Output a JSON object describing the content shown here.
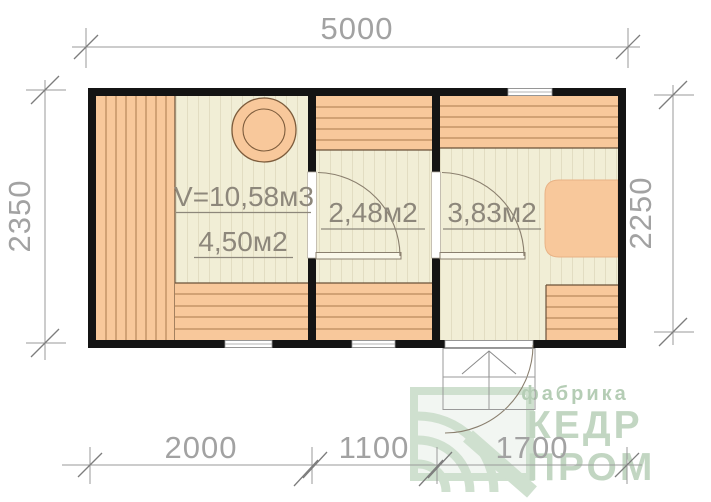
{
  "plan": {
    "dims": {
      "top": "5000",
      "left": "2350",
      "right": "2250",
      "bottom": [
        "2000",
        "1100",
        "1700"
      ]
    },
    "rooms": [
      {
        "id": "steam-room",
        "volume": "V=10,58м3",
        "area": "4,50м2"
      },
      {
        "id": "washing-room",
        "area": "2,48м2"
      },
      {
        "id": "rest-room",
        "area": "3,83м2"
      }
    ],
    "watermark": {
      "factory": "фабрика",
      "brand_top": "КЕДР",
      "brand_bottom": "ПРОМ"
    },
    "colors": {
      "wall": "#141414",
      "wood": "#f8c89b",
      "wood_line": "#aa7a4e",
      "wood_edge": "#6b5138",
      "floor": "#f1eed6",
      "floor_stripe": "#e2ddc2",
      "dim_line": "#9a9a9a",
      "dim_text": "#a2a2a2",
      "label_text": "#8d877b",
      "watermark_green": "#c2d6c2"
    }
  }
}
